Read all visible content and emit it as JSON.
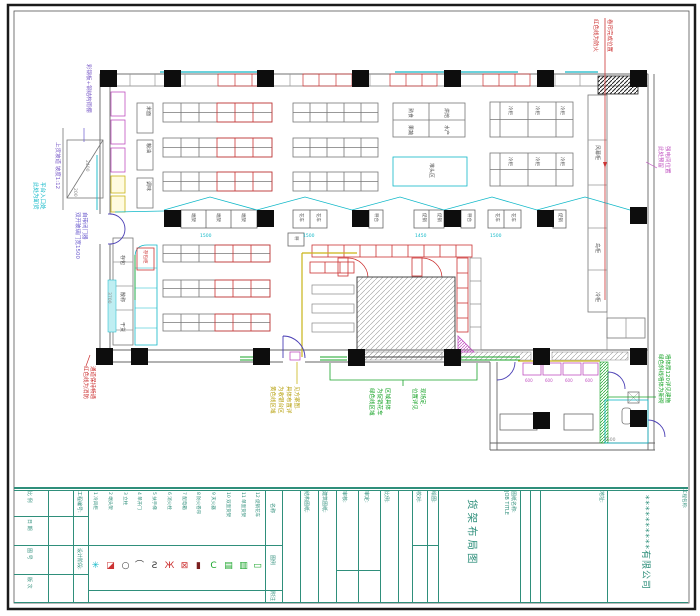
{
  "sheet": {
    "colors": {
      "border": "#1a1a1a",
      "titleblock_teal": "#2f8f7b",
      "wall_gray": "#666666",
      "shelf_gray": "#8a8a8a",
      "red": "#cc3333",
      "cyan": "#10b8c8",
      "magenta": "#c050c0",
      "green": "#18a428",
      "yellow": "#c9b518",
      "purple": "#6a5acd",
      "column_black": "#0d0d0d"
    }
  },
  "plan": {
    "notes": [
      "彩钢板+钢结构雨棚",
      "上货坡道 坡度1:12",
      "此处为卸货",
      "平台入口处",
      "双开玻璃门宽1500",
      "自带闭门器",
      "红色线为消防",
      "通道保持畅通",
      "红色线为防火",
      "卷帘完成位置",
      "此处预留",
      "强电间位置",
      "黄色线区域",
      "为收银台区",
      "具体布置详",
      "见方案图.",
      "绿色线区域",
      "为促销花车",
      "区域具体",
      "位置详见",
      "现场定.",
      "绿色斜线墙体为新砌",
      "墙体厚120详见建施"
    ],
    "labels": {
      "rice": "米面",
      "oil": "粮油",
      "spice": "调味",
      "locker": "存包",
      "bulk": "散称",
      "dry": "干货",
      "lockerbox": "存包柜",
      "aircurtain": "风幕柜",
      "island": "岛柜",
      "cooler": "冷柜",
      "deli": "熟食",
      "bakery": "烘焙",
      "produce": "果蔬",
      "seafood": "水产",
      "pile": "堆头区",
      "endcap": "端架",
      "cart": "花车",
      "scale": "秤台",
      "promo": "促销",
      "scale2": "秤"
    },
    "dims": {
      "d200": "200",
      "d2400": "2400",
      "d3700": "3700",
      "d7500": "7500",
      "d1500": "1500",
      "d1450": "1450",
      "d600": "600"
    }
  },
  "legend": {
    "row_name": "名称",
    "row_sym": "图例",
    "row_note": "附注",
    "items": [
      "1 冷风柜",
      "2 端头架",
      "3 立柱",
      "4 单开门",
      "5 扶手梯",
      "6 消火栓",
      "7 配电箱",
      "8 防火卷帘",
      "9 灭火器",
      "10 双面货架",
      "11 单面货架",
      "12 促销花车"
    ],
    "symbols": [
      "✳",
      "◪",
      "○",
      "⌒",
      "Ƨ",
      "Ж",
      "⊠",
      "▮",
      "C",
      "▤",
      "▥",
      "▭"
    ]
  },
  "title_block": {
    "scale_label": "比 例",
    "date_label": "日 期",
    "dwg_label": "图 号",
    "rev_label": "版 次",
    "jobno_label": "工程编号:",
    "phase_label": "设计阶段:",
    "col_structure": "结构图纸:",
    "col_arch": "建筑图纸:",
    "col_check": "审核:",
    "col_approve": "审定:",
    "col_scale2": "比例:",
    "proof_label": "校对:",
    "draw_label": "绘图:",
    "name_label": "图纸名称:",
    "name_label_en": "JOB TITLE",
    "drawing_title": "货架布局图",
    "addr_label": "地址:",
    "project_label": "工程名称:",
    "company": "**********有限公司"
  }
}
